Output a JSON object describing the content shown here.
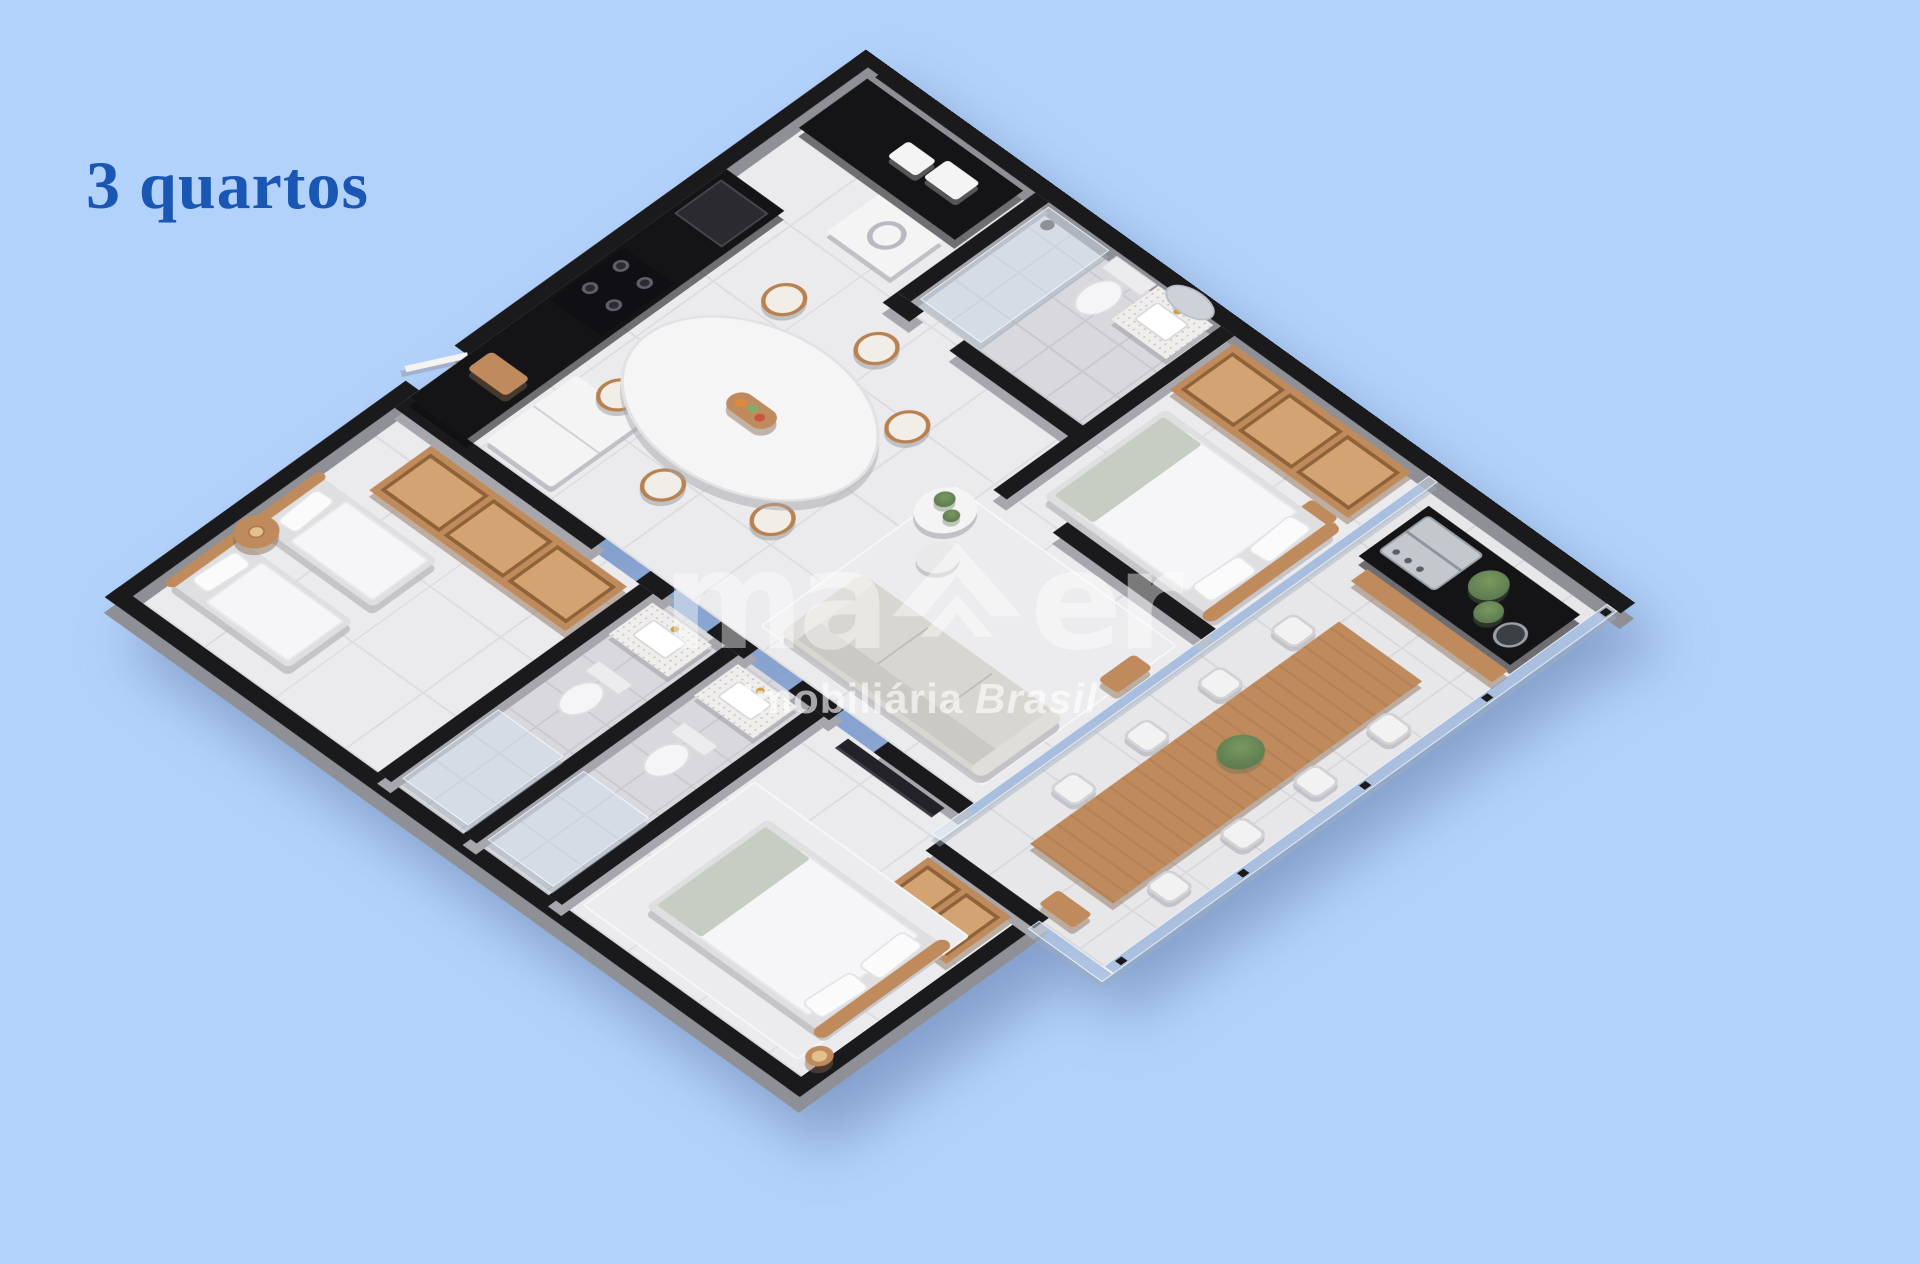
{
  "page": {
    "background_color": "#b3d2fb"
  },
  "title": {
    "text": "3 quartos",
    "color": "#1a56b4"
  },
  "watermark": {
    "logo_left": "ma",
    "logo_right": "er",
    "logo_icon": "chevron-house-icon",
    "tagline_regular": "Imobiliária",
    "tagline_italic": "Brasil",
    "color": "#ffffff"
  },
  "scene": {
    "type": "isometric-floor-plan",
    "rooms": [
      "kitchen",
      "bathroom-suite-top",
      "bedroom-1",
      "gourmet-balcony",
      "living-room",
      "dining-area",
      "bedroom-2",
      "bathroom-1",
      "bathroom-2",
      "bedroom-3"
    ],
    "colors": {
      "bg": "#b3d2fb",
      "title": "#1a56b4",
      "wall": "#1a1a1d",
      "wallsh": "#8f8f96",
      "intsh": "#a6a6ac",
      "floor": "#ebebee",
      "grout": "#dcdce1",
      "bathfloor": "#d9d9dd",
      "bathgrout": "#c9c9cf",
      "balcfloor": "#e7e7ea",
      "balcgrout": "#d9d9dd",
      "wood": "#c08b5c",
      "wooddark": "#8f6238",
      "woodlight": "#d3a472",
      "counter": "#141417",
      "steel": "#c4c8cd",
      "white": "#f4f4f5",
      "sage": "#c7cdc2",
      "sofa": "#d8d6d1",
      "rug": "#ececee",
      "plant": "#5d7c51",
      "gold": "#c9a24a"
    }
  }
}
